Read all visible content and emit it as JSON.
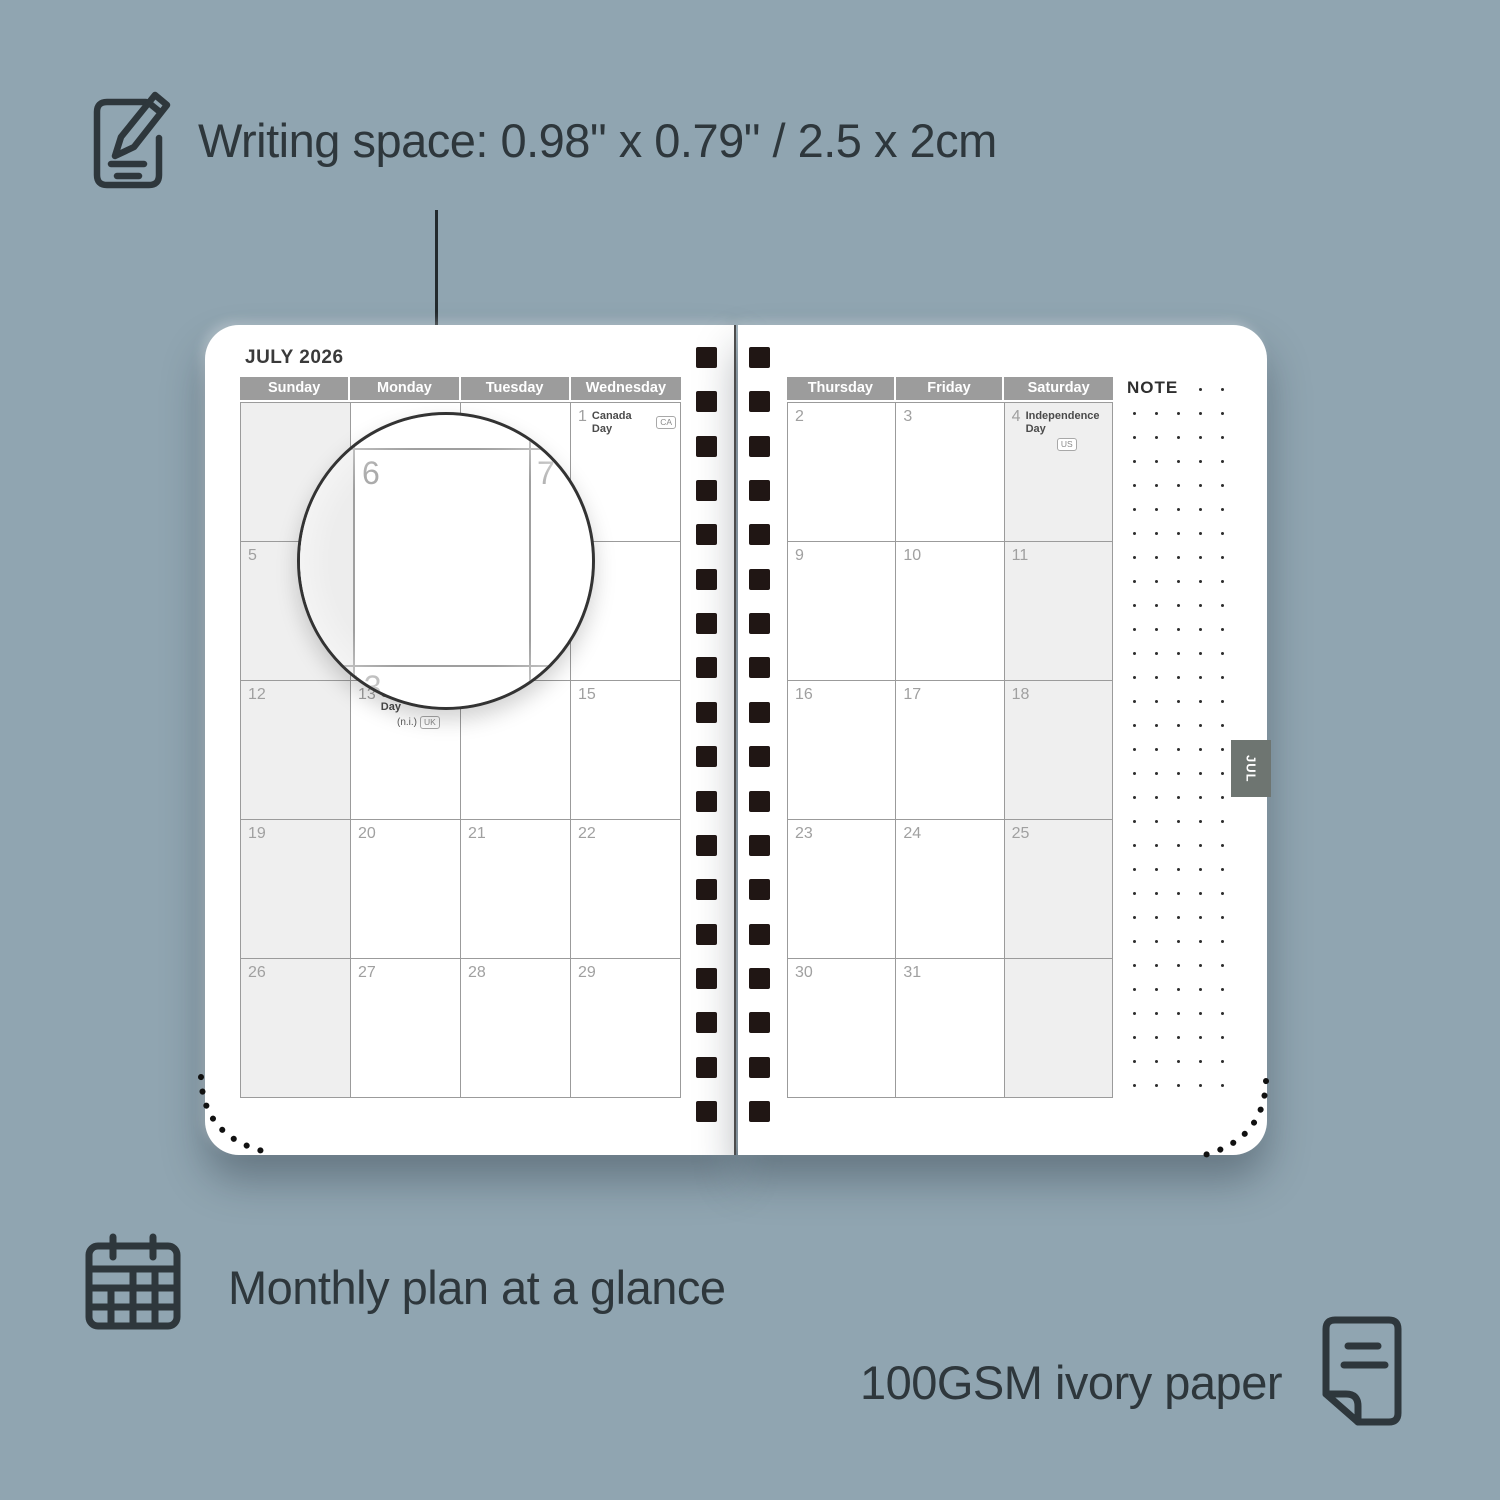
{
  "colors": {
    "background": "#90a5b1",
    "ink": "#2e373c",
    "header_gray": "#9c9c9c",
    "shade_gray": "#efefef",
    "tab_gray": "#6e7571"
  },
  "features": {
    "writing_space": {
      "label": "Writing space: 0.98\" x 0.79\" / 2.5 x 2cm",
      "icon": "note-pencil-icon"
    },
    "monthly_plan": {
      "label": "Monthly plan at a glance",
      "icon": "calendar-grid-icon"
    },
    "paper": {
      "label": "100GSM ivory paper",
      "icon": "paper-icon"
    }
  },
  "planner": {
    "title": "JULY 2026",
    "note_label": "NOTE",
    "tab_label": "JUL",
    "left_headers": [
      "Sunday",
      "Monday",
      "Tuesday",
      "Wednesday"
    ],
    "right_headers": [
      "Thursday",
      "Friday",
      "Saturday"
    ],
    "left_rows": [
      [
        {},
        {},
        {},
        {
          "day": "1",
          "holiday": "Canada Day",
          "badge": "CA"
        }
      ],
      [
        {
          "day": "5"
        },
        {
          "day": "6"
        },
        {
          "day": "7"
        },
        {
          "day": "8"
        }
      ],
      [
        {
          "day": "12"
        },
        {
          "day": "13",
          "holiday": "Orangemen's Day",
          "sub": "(n.i.)",
          "badge": "UK"
        },
        {
          "day": "14"
        },
        {
          "day": "15"
        }
      ],
      [
        {
          "day": "19"
        },
        {
          "day": "20"
        },
        {
          "day": "21"
        },
        {
          "day": "22"
        }
      ],
      [
        {
          "day": "26"
        },
        {
          "day": "27"
        },
        {
          "day": "28"
        },
        {
          "day": "29"
        }
      ]
    ],
    "right_rows": [
      [
        {
          "day": "2"
        },
        {
          "day": "3"
        },
        {
          "day": "4",
          "holiday": "Independence Day",
          "badge": "US",
          "badge_below": true
        }
      ],
      [
        {
          "day": "9"
        },
        {
          "day": "10"
        },
        {
          "day": "11"
        }
      ],
      [
        {
          "day": "16"
        },
        {
          "day": "17"
        },
        {
          "day": "18"
        }
      ],
      [
        {
          "day": "23"
        },
        {
          "day": "24"
        },
        {
          "day": "25"
        }
      ],
      [
        {
          "day": "30"
        },
        {
          "day": "31"
        },
        {}
      ]
    ]
  },
  "magnifier": {
    "day_main": "6",
    "day_adjacent": "7",
    "day_partial": "13"
  }
}
